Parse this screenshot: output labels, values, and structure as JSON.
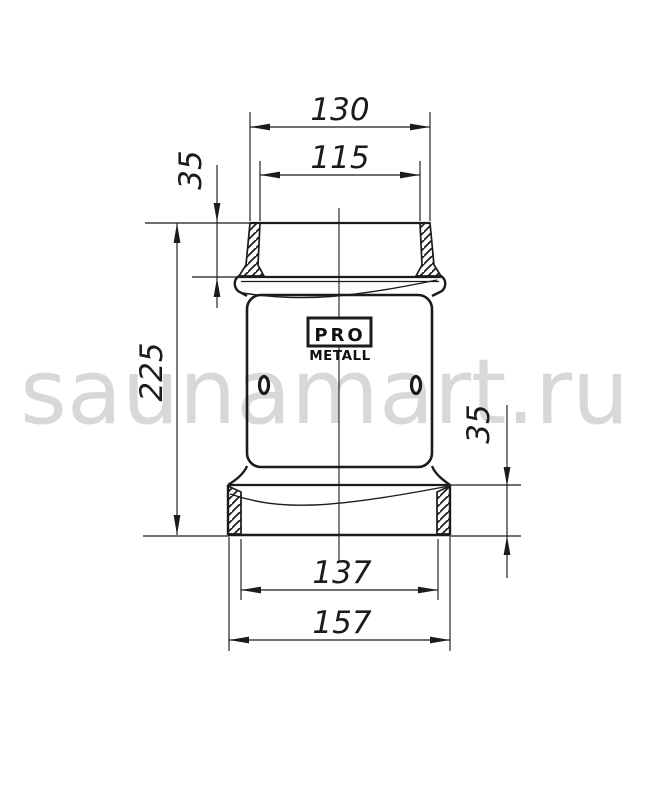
{
  "watermark": {
    "text": "saunamart.ru",
    "color": "#d8d8d8"
  },
  "logo": {
    "line1": "PRO",
    "line2": "METALL"
  },
  "dimensions": {
    "top_outer_width": "130",
    "top_inner_width": "115",
    "top_socket_height": "35",
    "total_height": "225",
    "bottom_collar_height": "35",
    "bottom_inner_width": "137",
    "bottom_outer_width": "157"
  },
  "colors": {
    "line": "#1b1b1b",
    "background": "#ffffff",
    "watermark": "#d8d8d8"
  }
}
